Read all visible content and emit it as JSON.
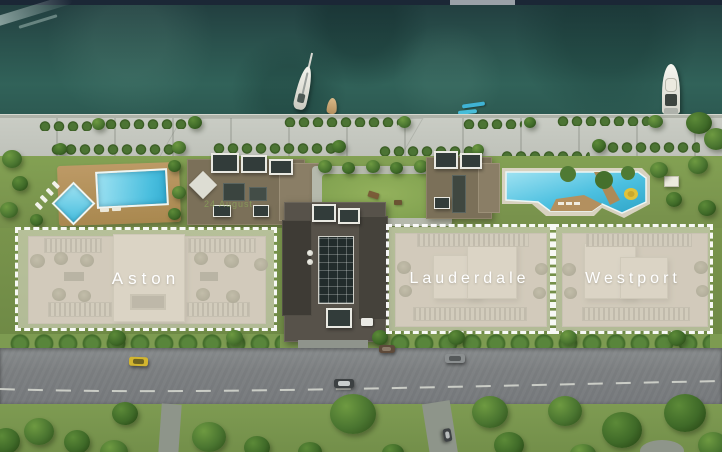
{
  "plan": {
    "title": "Waterfront residences site plan",
    "watermark_text": "24 August",
    "regions": [
      {
        "id": "aston",
        "label": "Aston"
      },
      {
        "id": "lauderdale",
        "label": "Lauderdale"
      },
      {
        "id": "westport",
        "label": "Westport"
      }
    ],
    "colors": {
      "water": "#2a524d",
      "pool_blue": "#4cc0e0",
      "lawn_green": "#7d9b51",
      "road_grey": "#7e8183",
      "boardwalk": "#c2c5bd",
      "region_overlay": "rgba(233,228,216,0.55)",
      "region_border": "#ffffff",
      "label_text": "#ffffff",
      "top_bar": "#1b2736"
    },
    "scene_objects": {
      "boats": [
        "sailboat",
        "dinghy",
        "kayak",
        "kayak",
        "yacht"
      ],
      "vehicles": [
        "yellow-car",
        "dark-sedan",
        "brown-car",
        "grey-sedan",
        "parked-car",
        "white-van"
      ]
    }
  }
}
